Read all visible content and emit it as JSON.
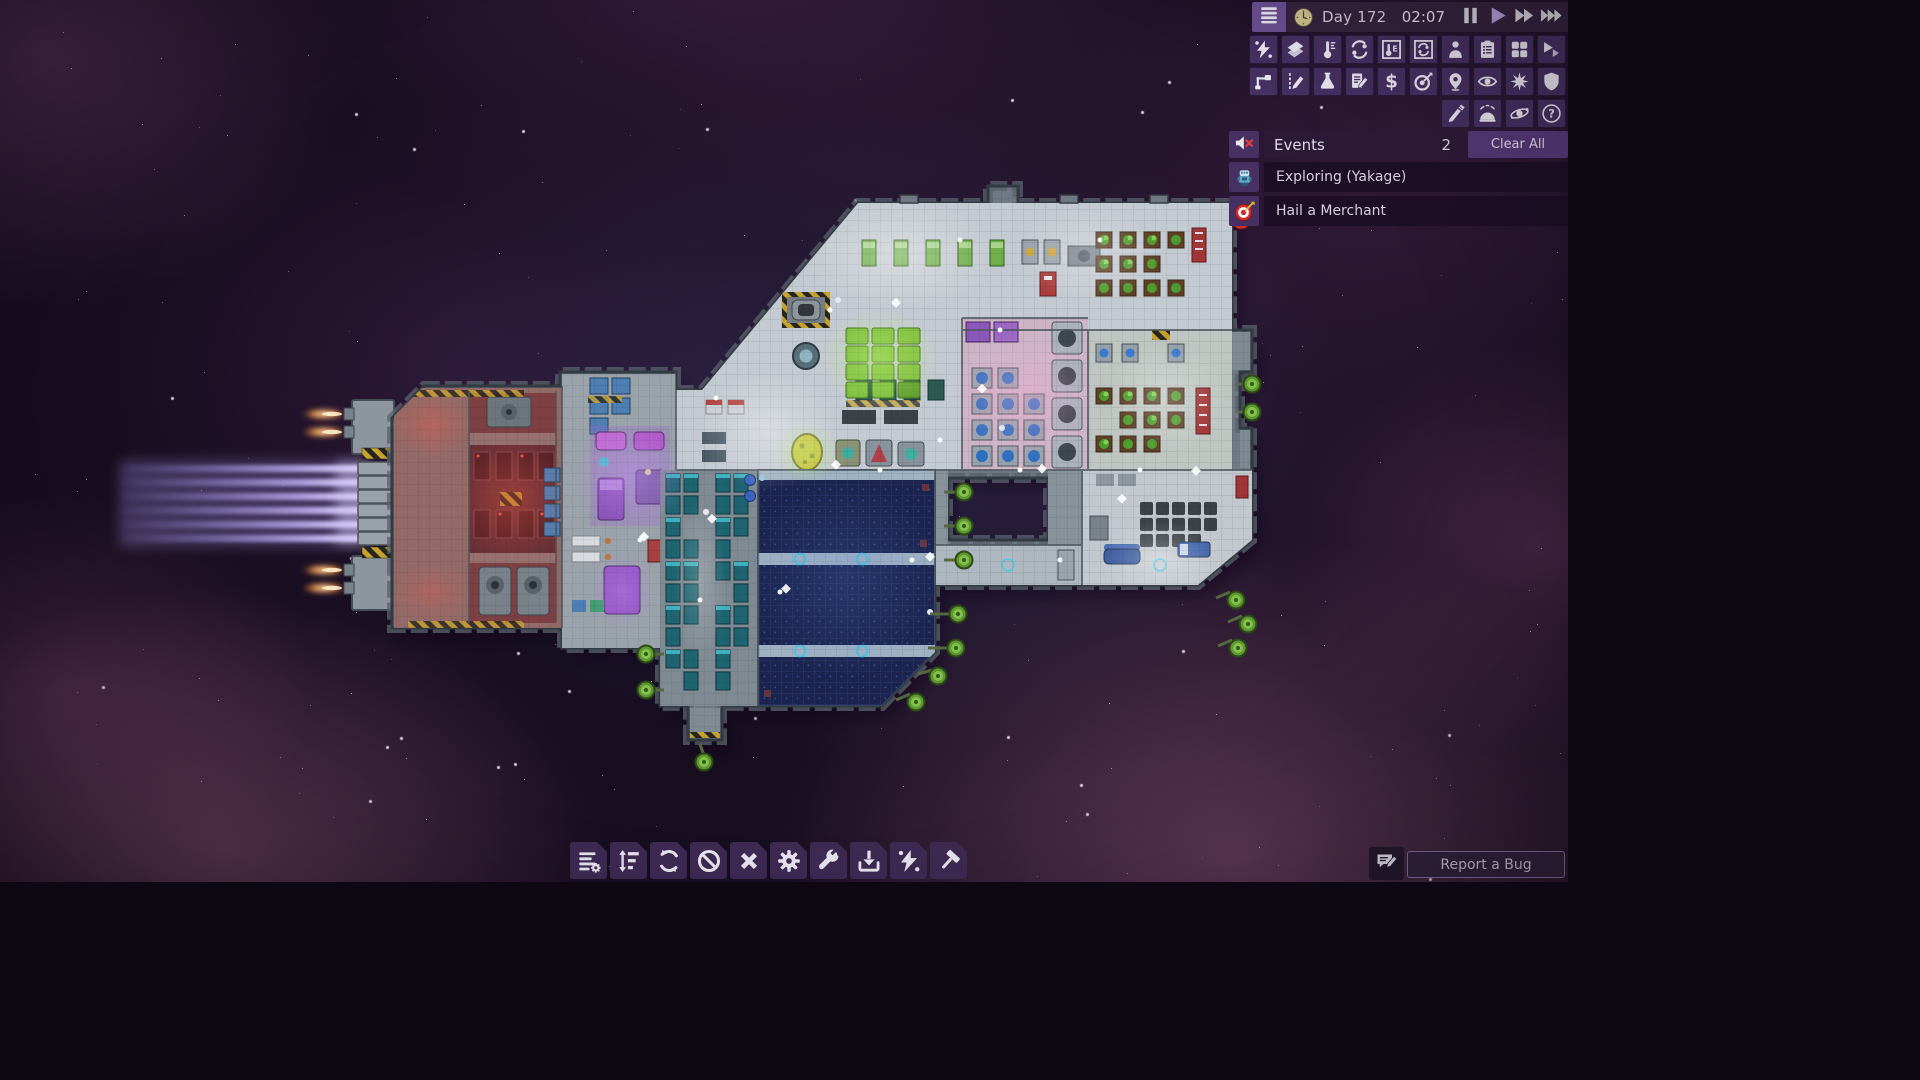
{
  "topbar": {
    "day": "Day 172",
    "time": "02:07",
    "controls": [
      {
        "name": "pause",
        "icon": "pause"
      },
      {
        "name": "play",
        "icon": "play",
        "active": true
      },
      {
        "name": "fast-forward",
        "icon": "ff2"
      },
      {
        "name": "fastest-forward",
        "icon": "ff3"
      }
    ]
  },
  "view_toolbar": {
    "rows": [
      [
        {
          "name": "power-view",
          "icon": "bolt-dots"
        },
        {
          "name": "hull-view",
          "icon": "layers"
        },
        {
          "name": "temperature-view",
          "icon": "thermometer"
        },
        {
          "name": "gas-view",
          "icon": "gas"
        },
        {
          "name": "temperature-overlay",
          "icon": "thermometer-box"
        },
        {
          "name": "gas-overlay",
          "icon": "gas-box"
        },
        {
          "name": "crew-view",
          "icon": "person"
        },
        {
          "name": "schedule-view",
          "icon": "clipboard"
        },
        {
          "name": "storage-view",
          "icon": "grid4"
        },
        {
          "name": "shuttle-view",
          "icon": "shuttle"
        }
      ],
      [
        {
          "name": "conduits-view",
          "icon": "conduit"
        },
        {
          "name": "draw-plan",
          "icon": "pencil-dashed"
        },
        {
          "name": "research-view",
          "icon": "flask"
        },
        {
          "name": "data-logs",
          "icon": "doc-pencil"
        },
        {
          "name": "trade-view",
          "icon": "dollar"
        },
        {
          "name": "missions-view",
          "icon": "target-dart"
        },
        {
          "name": "navigation-view",
          "icon": "map-pin"
        },
        {
          "name": "observe-view",
          "icon": "eye"
        },
        {
          "name": "combat-view",
          "icon": "starburst"
        },
        {
          "name": "shields-view",
          "icon": "shield"
        }
      ],
      [
        {
          "name": "customize",
          "icon": "brush"
        },
        {
          "name": "hypersleep-view",
          "icon": "dome-waves"
        },
        {
          "name": "system-view",
          "icon": "orbit"
        },
        {
          "name": "help",
          "icon": "question"
        }
      ]
    ]
  },
  "events": {
    "title": "Events",
    "count": "2",
    "clear_label": "Clear All",
    "items": [
      {
        "label": "Exploring (Yakage)",
        "icon": "explorer-sprite"
      },
      {
        "label": "Hail a Merchant",
        "icon": "target-red"
      }
    ]
  },
  "build_toolbar": {
    "items": [
      {
        "name": "manage-list",
        "icon": "list-gear"
      },
      {
        "name": "priorities",
        "icon": "priority-bars"
      },
      {
        "name": "rotate",
        "icon": "rotate-arrows"
      },
      {
        "name": "forbid",
        "icon": "no-entry"
      },
      {
        "name": "deconstruct",
        "icon": "cancel-x"
      },
      {
        "name": "settings",
        "icon": "gear"
      },
      {
        "name": "repair",
        "icon": "wrench"
      },
      {
        "name": "install",
        "icon": "install-arrow"
      },
      {
        "name": "power",
        "icon": "bolt-dots"
      },
      {
        "name": "build",
        "icon": "hammer"
      }
    ]
  },
  "report_bug": {
    "label": "Report a Bug",
    "icon": "chat-pencil"
  },
  "colors": {
    "panel": "#463162",
    "panel_dark": "#3e2b54",
    "bar": "#35243e",
    "menu_tile": "#6b5093",
    "clear_button": "#553a78",
    "accent_text": "#d6d0de",
    "play_active": "#b7a2e2",
    "mute_x": "#e23b3b",
    "event_row_bg": "#1a0e24",
    "beam_purple": "#b7a7ea",
    "flame_orange": "#ff9a3c",
    "farm_green": "#7fbf3f",
    "solar_blue": "#1a244e"
  }
}
